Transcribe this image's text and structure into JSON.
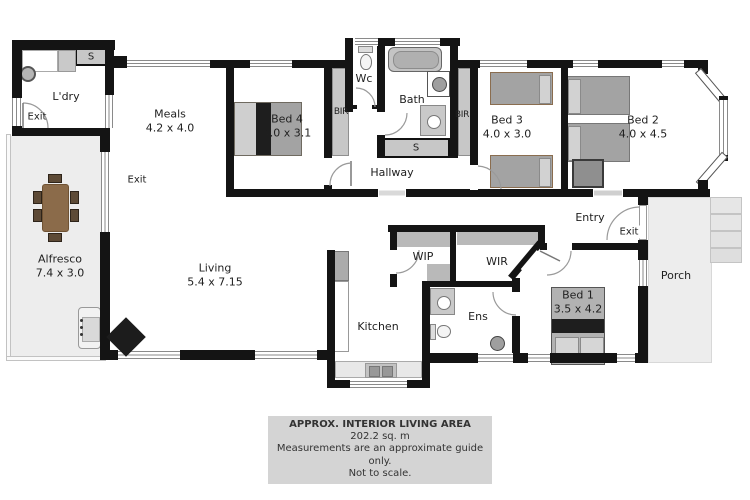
{
  "rooms": {
    "ldry": {
      "name": "L'dry"
    },
    "meals": {
      "name": "Meals",
      "dims": "4.2 x 4.0"
    },
    "bed4": {
      "name": "Bed 4",
      "dims": "4.0 x 3.1"
    },
    "wc": {
      "name": "Wc"
    },
    "bath": {
      "name": "Bath"
    },
    "bed3": {
      "name": "Bed 3",
      "dims": "4.0 x 3.0"
    },
    "bed2": {
      "name": "Bed 2",
      "dims": "4.0 x 4.5"
    },
    "hallway": {
      "name": "Hallway"
    },
    "alfresco": {
      "name": "Alfresco",
      "dims": "7.4 x 3.0"
    },
    "living": {
      "name": "Living",
      "dims": "5.4 x 7.15"
    },
    "kitchen": {
      "name": "Kitchen"
    },
    "wip": {
      "name": "WIP"
    },
    "wir": {
      "name": "WIR"
    },
    "ens": {
      "name": "Ens"
    },
    "bed1": {
      "name": "Bed 1",
      "dims": "3.5 x 4.2"
    },
    "entry": {
      "name": "Entry"
    },
    "porch": {
      "name": "Porch"
    }
  },
  "closets": {
    "laundry_s": "S",
    "bath_s": "S",
    "bir_left": "BIR",
    "bir_right": "BIR"
  },
  "exits": {
    "laundry": "Exit",
    "living_side": "Exit",
    "entry": "Exit"
  },
  "caption": {
    "line1": "APPROX. INTERIOR LIVING AREA",
    "line2": "202.2 sq. m",
    "line3": "Measurements are an approximate guide only.",
    "line4": "Not to scale."
  },
  "colors": {
    "wall": "#141414",
    "outdoor": "#ededed",
    "closet": "#c7c7c7",
    "shelf": "#b9b9b9",
    "caption_bg": "#d4d4d4",
    "text": "#1f1f1f",
    "bed_gray": "#a3a3a3",
    "pillow": "#d2d2d2",
    "dark_band": "#1e1e1e",
    "table_brown": "#8b6b4a",
    "chair_brown": "#5d4a36"
  }
}
